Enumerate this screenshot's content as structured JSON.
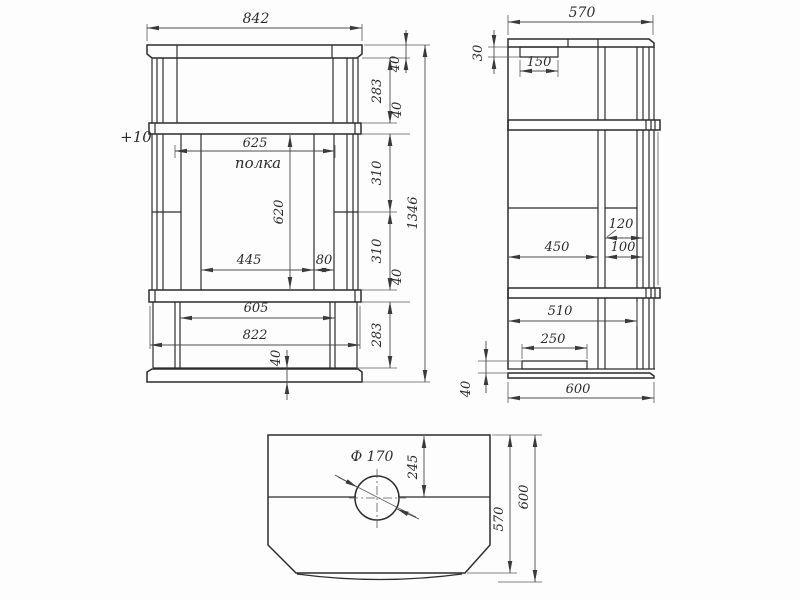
{
  "front_view": {
    "top_width": "842",
    "crown_height": "40",
    "upper_section": "283",
    "band_top": "40",
    "shelf_width": "625",
    "shelf_label": "полка",
    "shelf_note": "+10",
    "opening_height": "620",
    "opening_upper": "310",
    "opening_lower": "310",
    "band_bottom": "40",
    "opening_width": "445",
    "column_width": "80",
    "lower_width_inner": "605",
    "lower_width_outer": "822",
    "lower_section": "283",
    "plinth_height": "40",
    "total_height": "1346"
  },
  "side_view": {
    "top_depth": "570",
    "bracket_height": "30",
    "bracket_width": "150",
    "column_depth": "120",
    "front_depth": "450",
    "column_gap": "100",
    "lower_depth": "510",
    "foot_width": "250",
    "plinth_height": "40",
    "bottom_depth": "600"
  },
  "top_view": {
    "hole_diameter": "Ф 170",
    "hole_offset": "245",
    "inner_depth": "570",
    "outer_depth": "600"
  }
}
